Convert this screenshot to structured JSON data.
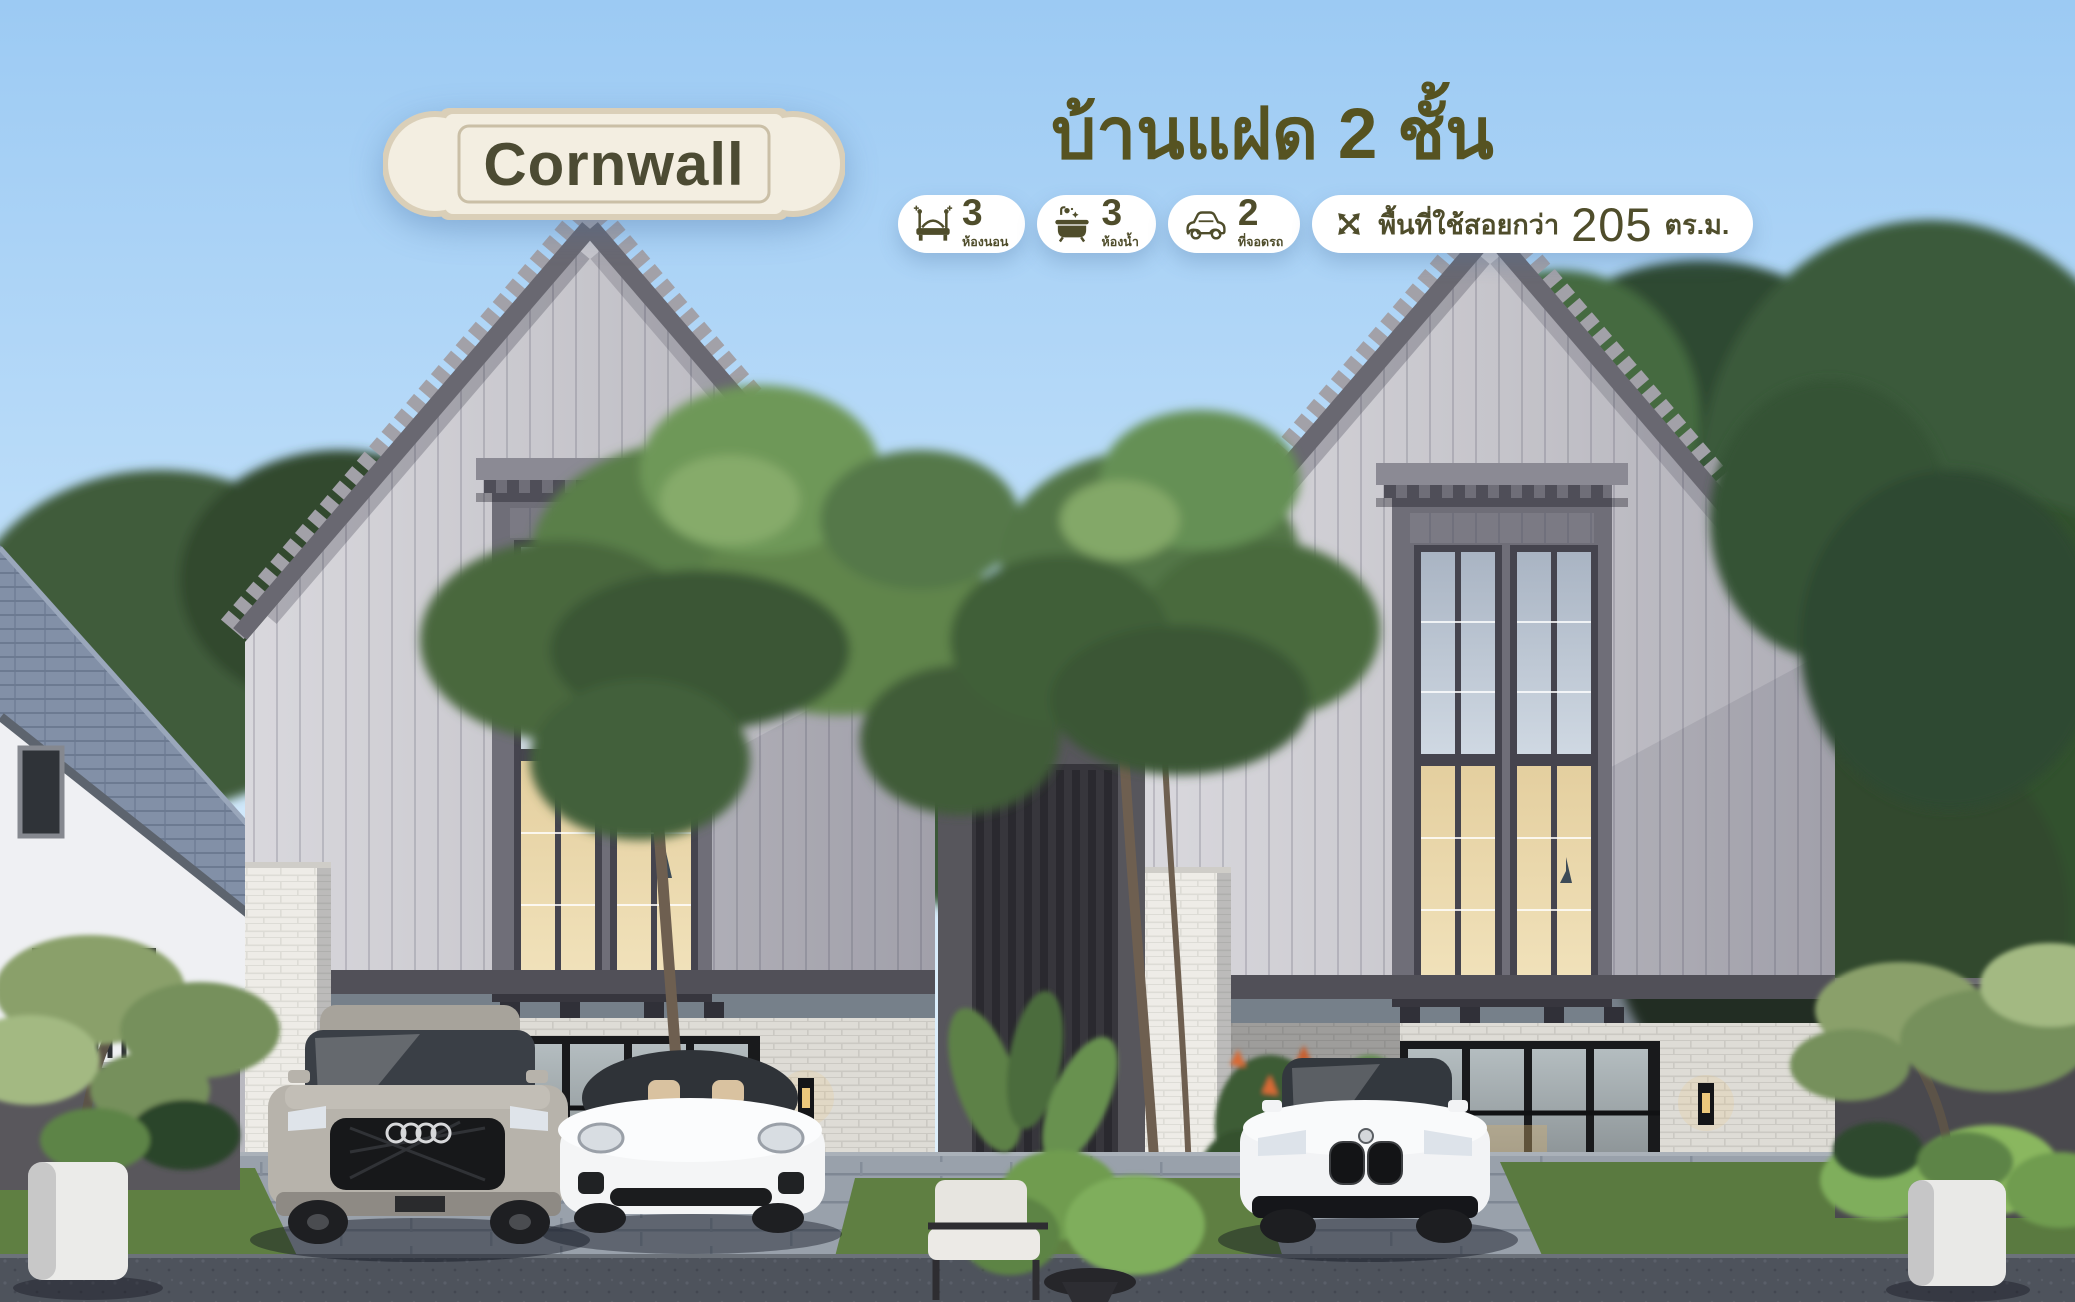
{
  "plaque": {
    "name": "Cornwall"
  },
  "headline": "บ้านแฝด 2 ชั้น",
  "badges": {
    "bedrooms": {
      "value": "3",
      "label": "ห้องนอน"
    },
    "bathrooms": {
      "value": "3",
      "label": "ห้องน้ำ"
    },
    "parking": {
      "value": "2",
      "label": "ที่จอดรถ"
    },
    "area": {
      "prefix": "พื้นที่ใช้สอยกว่า",
      "value": "205",
      "unit": "ตร.ม."
    }
  },
  "colors": {
    "accent_olive": "#4f4d2b",
    "headline_olive": "#565321",
    "plaque_bg": "#f3eee1",
    "plaque_border": "#dacfb8",
    "badge_bg": "#ffffff",
    "sky_top": "#9ccaf3",
    "sky_horizon": "#dceffd",
    "house_siding": "#c6c5cb",
    "roof_fascia": "#696871",
    "window_warm_glow": "#ead7ab",
    "foliage_green": "#5a7f49",
    "driveway": "#99a1ab",
    "road": "#4e535c"
  },
  "scene": {
    "subject": "Photorealistic rendering of two-storey twin houses with steep grey gable roofs, tall two-storey bay windows with warm interior light, white-brick ground floor with glass doors and wall lanterns, garden trees, outdoor chair, and three parked cars",
    "cars": [
      "grey SUV",
      "white sports sedan",
      "white compact sedan"
    ]
  }
}
